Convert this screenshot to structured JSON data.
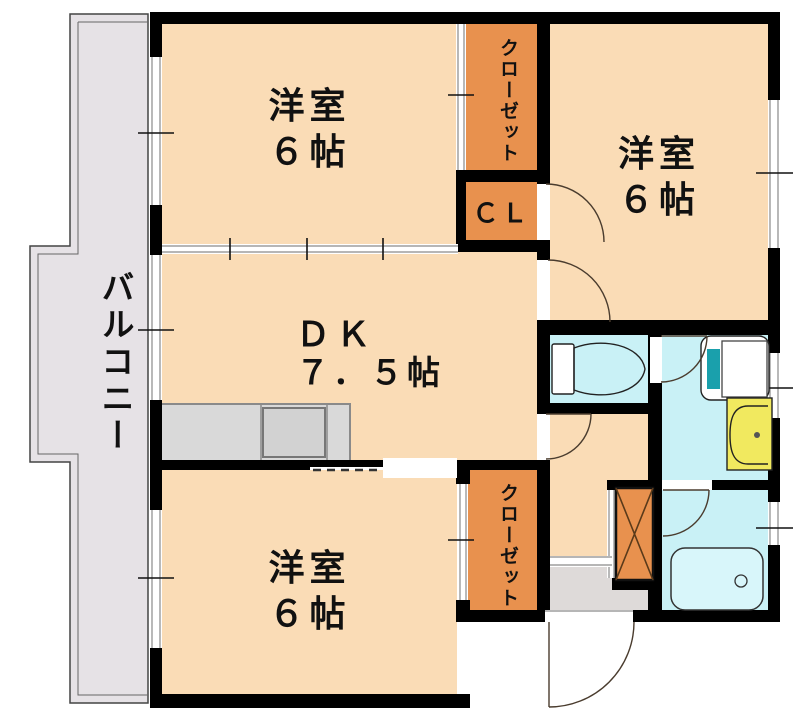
{
  "floor_plan": {
    "rooms": {
      "bedroom_top_left": {
        "label": "洋室",
        "size": "６帖"
      },
      "bedroom_top_right": {
        "label": "洋室",
        "size": "６帖"
      },
      "bedroom_bottom": {
        "label": "洋室",
        "size": "６帖"
      },
      "dining_kitchen": {
        "label": "ＤＫ",
        "size": "７．５帖"
      },
      "closet_top": {
        "label": "クローゼット"
      },
      "closet_cl": {
        "label": "ＣＬ"
      },
      "closet_bottom": {
        "label": "クローゼット"
      },
      "balcony": {
        "label": "バルコニー"
      }
    },
    "fixtures": {
      "toilet": "toilet-icon",
      "washing_machine": "washing-machine-icon",
      "wash_basin": "wash-basin-icon",
      "bathtub": "bathtub-icon",
      "kitchen_counter": "kitchen-counter",
      "shoe_cabinet": "shoe-cabinet"
    },
    "colors": {
      "wall_color": "#000000",
      "room_fill": "#FADCB6",
      "closet_fill": "#E8914E",
      "wet_area_fill": "#C9F1F6",
      "vanity_yellow": "#F1E95F",
      "appliance_teal": "#1AA0AC",
      "kitchen_gray": "#D9D9D9",
      "entrance_gray": "#DEDAD9",
      "balcony_gray": "#E6E2E6"
    }
  }
}
